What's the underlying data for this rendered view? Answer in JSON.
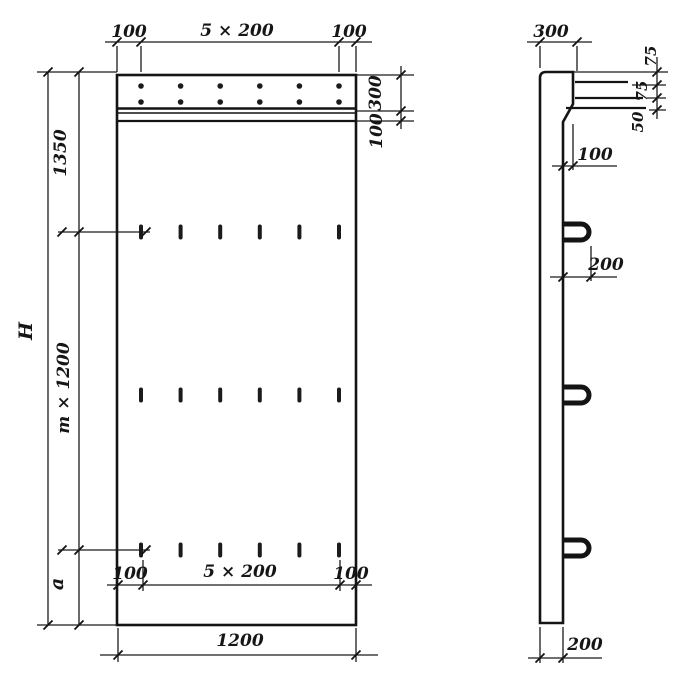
{
  "drawing_type": "precast panel working drawing",
  "front_view": {
    "top_dimensions": {
      "left_margin": "100",
      "spacing": "5 × 200",
      "right_margin": "100"
    },
    "right_dimensions": {
      "cap_band_height": "300",
      "band_offset": "100"
    },
    "left_dimensions": {
      "top_section": "1350",
      "overall_height": "H",
      "module_height": "m × 1200",
      "bottom_section": "a"
    },
    "bottom_dimensions": {
      "left_margin": "100",
      "spacing": "5 × 200",
      "right_margin": "100",
      "overall_width": "1200"
    }
  },
  "side_view": {
    "top_width": "300",
    "cap_dimensions": {
      "upper": "75",
      "middle": "75",
      "lower": "50"
    },
    "step_offset": "100",
    "loop_projection": "200",
    "panel_thickness": "200"
  },
  "colors": {
    "ink": "#1b1b1b",
    "paper": "#ffffff"
  }
}
